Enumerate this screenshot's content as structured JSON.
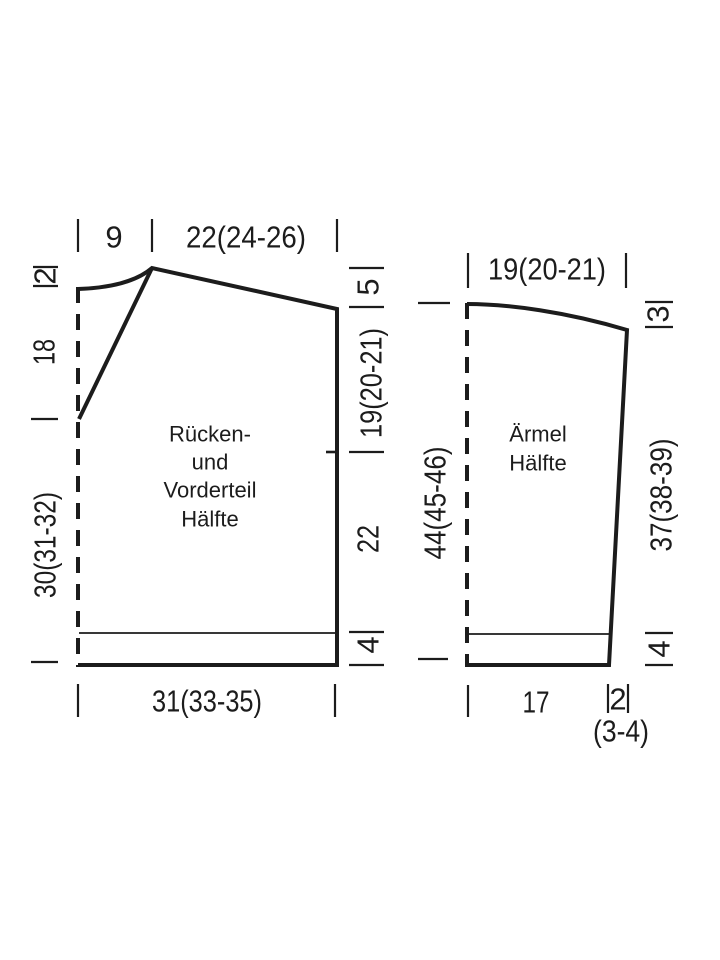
{
  "diagram": {
    "type": "knitting-pattern-schematic",
    "background": "#ffffff",
    "line_color": "#1c1c1c",
    "pieces": [
      {
        "name": "back-and-front-half",
        "label_lines": [
          "Rücken-",
          "und",
          "Vorderteil",
          "Hälfte"
        ],
        "dims": {
          "top": [
            "9",
            "22(24-26)"
          ],
          "left": [
            "2",
            "18",
            "30(31-32)"
          ],
          "right": [
            "5",
            "19(20-21)",
            "22",
            "4"
          ],
          "bottom": [
            "31(33-35)"
          ]
        }
      },
      {
        "name": "sleeve-half",
        "label_lines": [
          "Ärmel",
          "Hälfte"
        ],
        "dims": {
          "top": [
            "19(20-21)"
          ],
          "left": [
            "44(45-46)"
          ],
          "right": [
            "3",
            "37(38-39)",
            "4"
          ],
          "bottom": [
            "17",
            "2",
            "(3-4)"
          ]
        }
      }
    ]
  }
}
